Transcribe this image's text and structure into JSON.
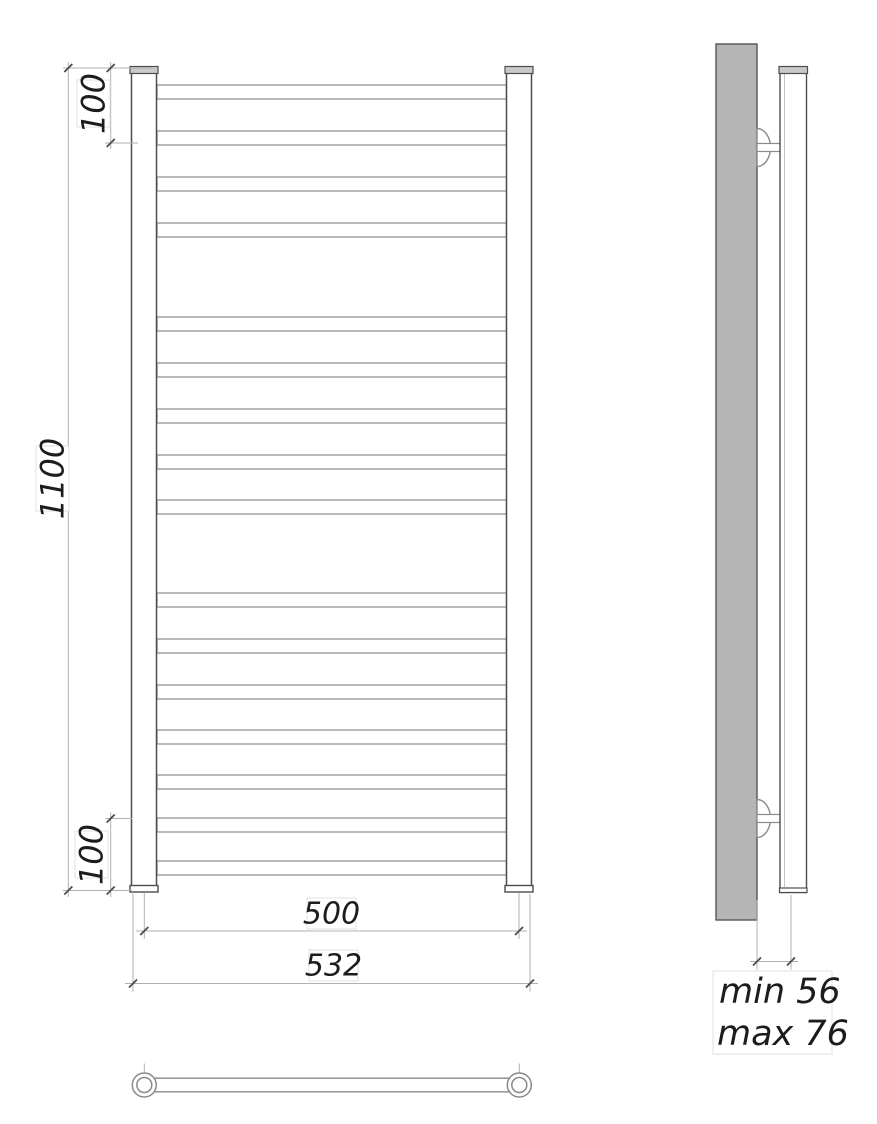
{
  "drawing": {
    "kind": "technical dimension drawing",
    "subject": "ladder towel rail, front view / side view / bottom view"
  },
  "labels": {
    "top_span": "100",
    "overall_height": "1100",
    "bottom_span": "100",
    "rail_axis_width": "500",
    "overall_width": "532",
    "wall_distance_min": "min 56",
    "wall_distance_max": "max 76"
  },
  "front_view": {
    "bar_count": 16,
    "bar_groups": [
      4,
      5,
      7
    ],
    "bar_x": 157,
    "bar_w": 349.5,
    "bar_h": 14,
    "bar_y": [
      85,
      131,
      177,
      223,
      317,
      363,
      409,
      455,
      500,
      593,
      639,
      685,
      730,
      775,
      818,
      861
    ]
  },
  "colors": {
    "outline_dark": "#4d4d4d",
    "outline_mid": "#8a8a8a",
    "bar_stroke": "#9c9c9c",
    "dim_line": "#b0b0b0",
    "text": "#1c1c1c",
    "wall_fill": "#b5b5b5",
    "cap_fill": "#c9c9c9",
    "frame_faint": "#e0e0e0"
  }
}
